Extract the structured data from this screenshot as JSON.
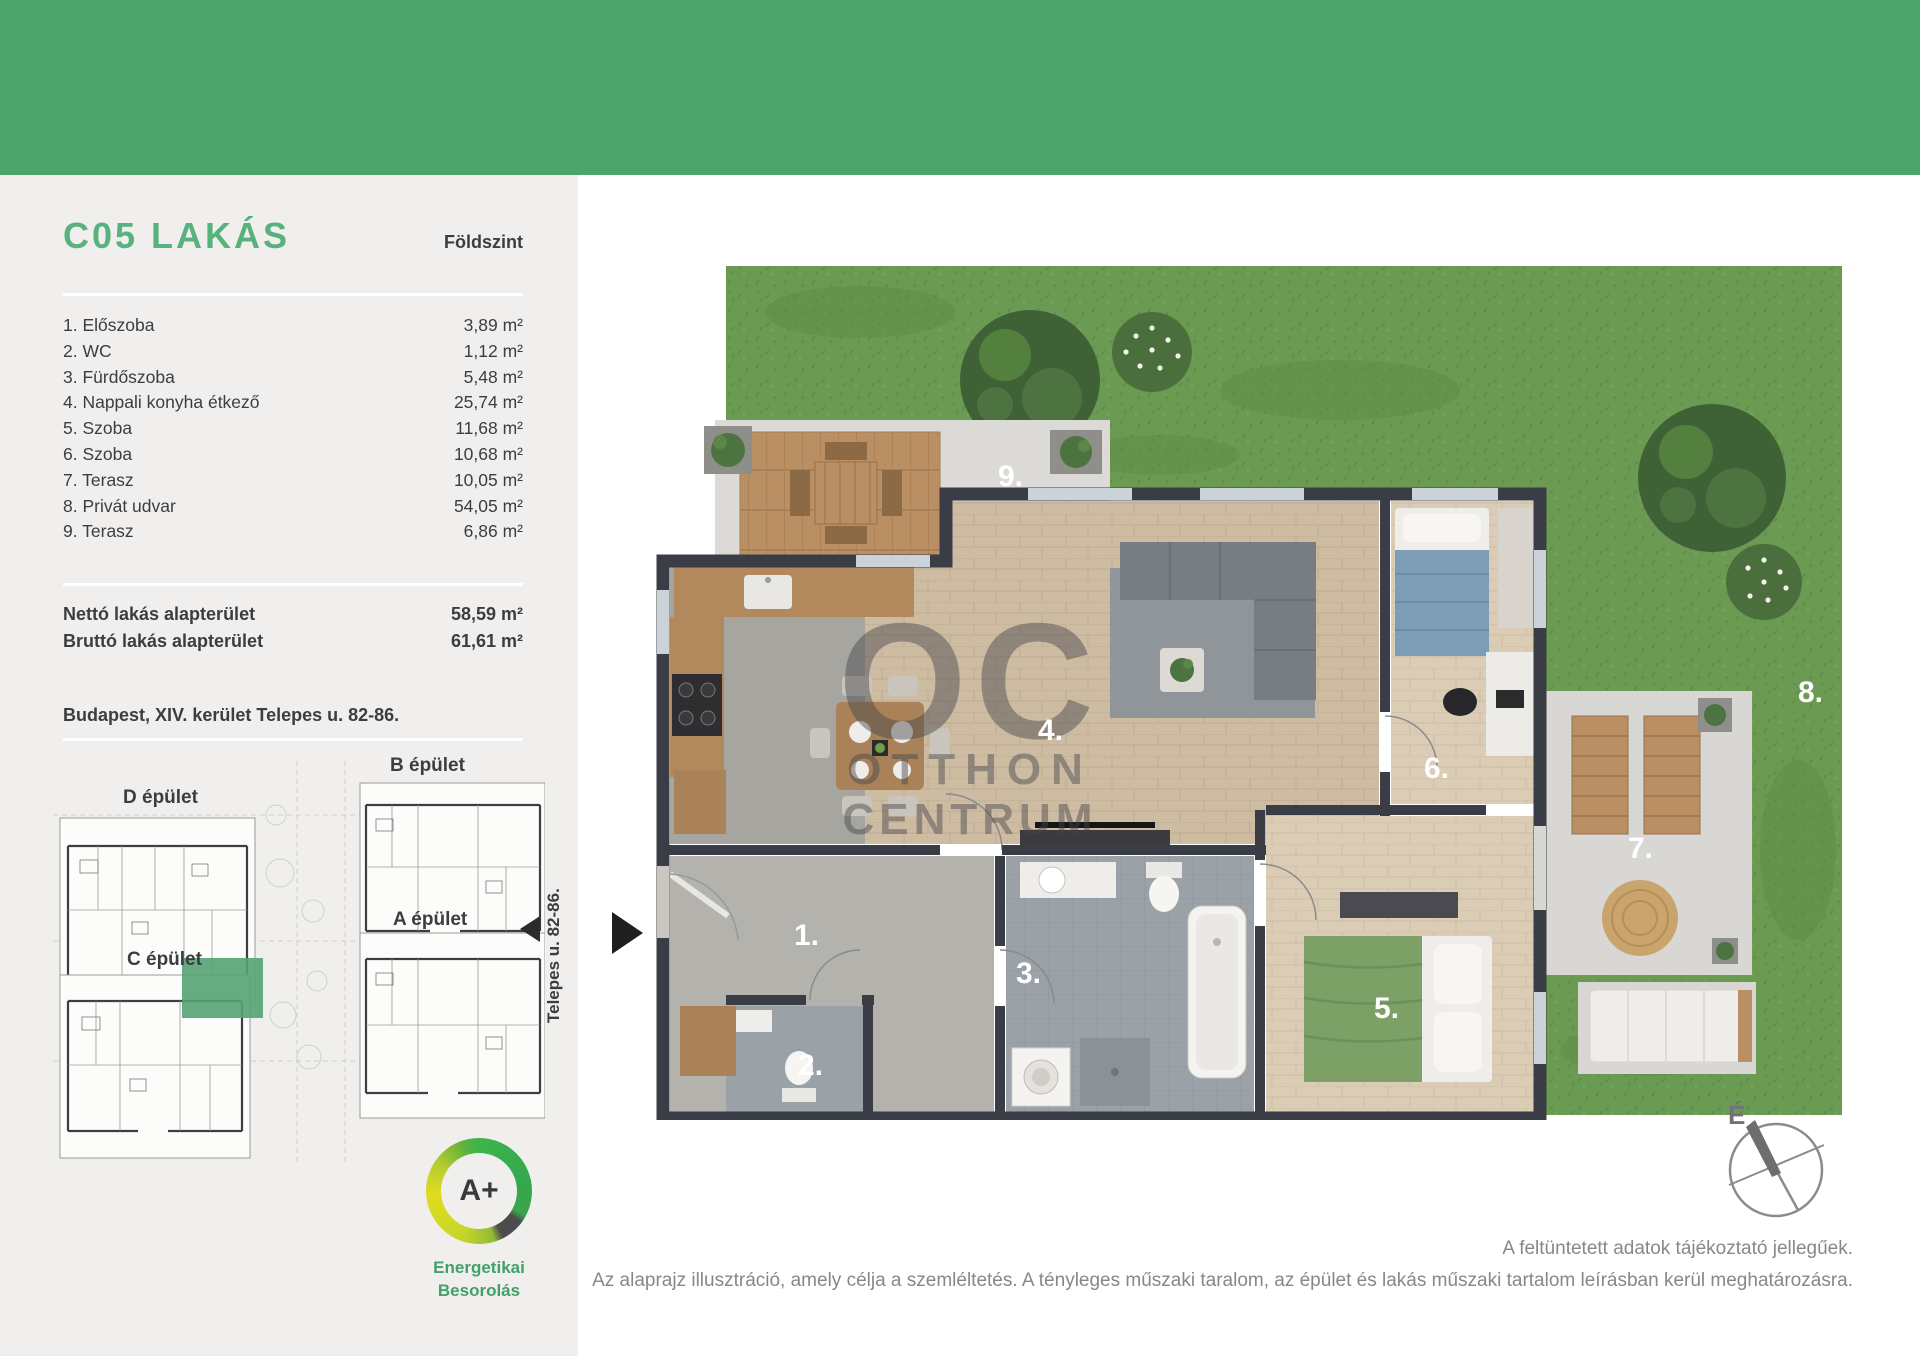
{
  "sidebar": {
    "title": "C05 LAKÁS",
    "floor": "Földszint",
    "rooms": [
      {
        "label": "1. Előszoba",
        "area": "3,89 m²"
      },
      {
        "label": "2. WC",
        "area": "1,12 m²"
      },
      {
        "label": "3. Fürdőszoba",
        "area": "5,48 m²"
      },
      {
        "label": "4. Nappali konyha étkező",
        "area": "25,74 m²"
      },
      {
        "label": "5. Szoba",
        "area": "11,68 m²"
      },
      {
        "label": "6. Szoba",
        "area": "10,68 m²"
      },
      {
        "label": "7. Terasz",
        "area": "10,05 m²"
      },
      {
        "label": "8. Privát udvar",
        "area": "54,05 m²"
      },
      {
        "label": "9. Terasz",
        "area": "6,86 m²"
      }
    ],
    "totals": [
      {
        "label": "Nettó lakás alapterület",
        "value": "58,59 m²"
      },
      {
        "label": "Bruttó lakás alapterület",
        "value": "61,61 m²"
      }
    ],
    "address": "Budapest, XIV. kerület Telepes u. 82-86.",
    "siteplan": {
      "building_b": "B épület",
      "building_d": "D épület",
      "building_a": "A épület",
      "building_c": "C épület",
      "street": "Telepes u. 82-86.",
      "highlight_color": "#57A273"
    },
    "energy": {
      "rating": "A+",
      "label1": "Energetikai",
      "label2": "Besorolás"
    }
  },
  "plan": {
    "numbers": {
      "n1": "1.",
      "n2": "2.",
      "n3": "3.",
      "n4": "4.",
      "n5": "5.",
      "n6": "6.",
      "n7": "7.",
      "n8": "8.",
      "n9": "9."
    },
    "watermark": {
      "l1": "OC",
      "l2": "OTTHON",
      "l3": "CENTRUM"
    },
    "compass": "É"
  },
  "footer": {
    "line1": "A feltüntetett adatok tájékoztató jellegűek.",
    "line2": "Az alaprajz illusztráció, amely célja a szemléltetés. A tényleges műszaki taralom, az épület és lakás műszaki tartalom leírásban kerül meghatározásra."
  },
  "colors": {
    "header_green": "#4DA56E",
    "accent_green": "#58B27E",
    "grass": "#6B9B52",
    "highlight": "#57A273"
  }
}
